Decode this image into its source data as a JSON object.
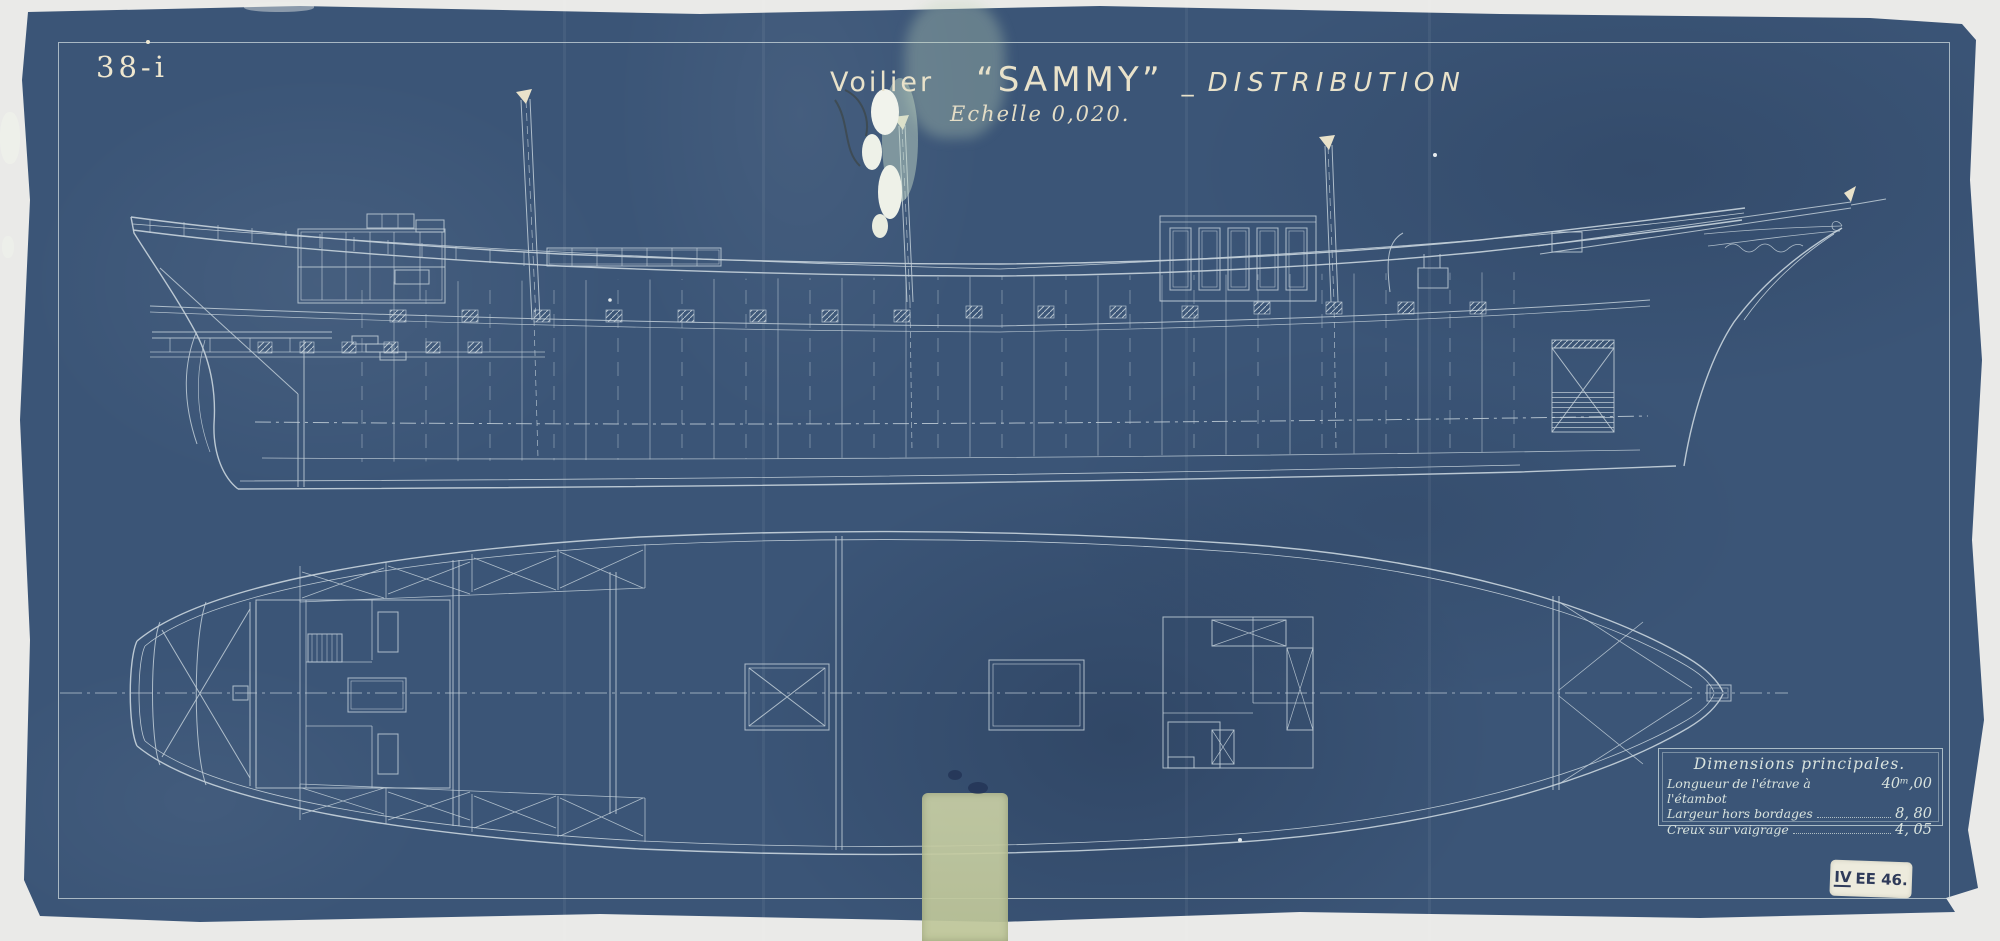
{
  "sheet": {
    "number": "38-i"
  },
  "title": {
    "vessel_type": "Voilier",
    "name": "“SAMMY”",
    "separator": "_",
    "subject": "DISTRIBUTION",
    "scale": "Echelle 0,020."
  },
  "dimensions_table": {
    "title": "Dimensions principales.",
    "rows": [
      {
        "label": "Longueur de l'étrave à l'étambot",
        "value": "40ᵐ,00"
      },
      {
        "label": "Largeur hors bordages",
        "value": "8, 80"
      },
      {
        "label": "Creux sur vaigrage",
        "value": "4, 05"
      }
    ]
  },
  "stamp": {
    "roman": "IV",
    "code": "EE 46."
  },
  "colors": {
    "paper": "#3b5577",
    "background": "#e9e9e7",
    "drawing_line": "#c2cfd8",
    "lettering_ink": "#ece4cc",
    "stamp_background": "#edebdd",
    "stamp_ink": "#2f3b5a",
    "tape_stain": "#c6cda2"
  }
}
